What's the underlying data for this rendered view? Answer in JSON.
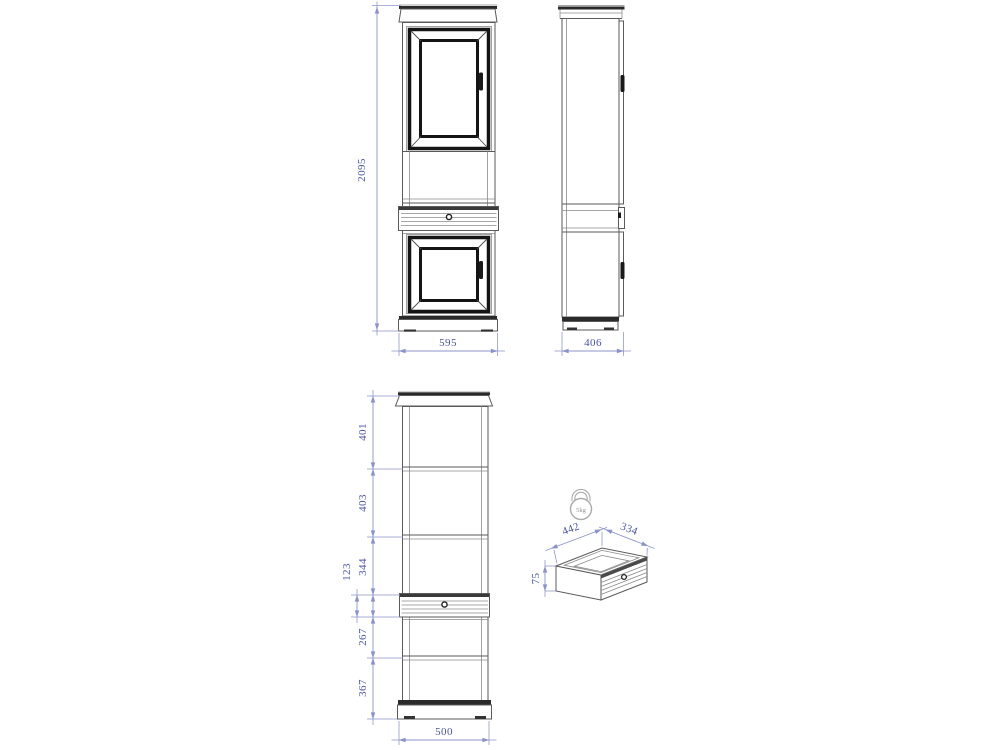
{
  "colors": {
    "background": "#ffffff",
    "object_line": "#5a5a5a",
    "door_frame": "#141414",
    "dimension_line": "#8b93c7",
    "dimension_text": "#4a55a2",
    "weight_icon": "#aaaaaa"
  },
  "views": {
    "front": {
      "name": "front elevation",
      "height": "2095",
      "width": "595"
    },
    "side": {
      "name": "side elevation",
      "width": "406"
    },
    "section": {
      "name": "front section with internal heights",
      "segments": [
        "401",
        "403",
        "344",
        "123",
        "267",
        "367"
      ],
      "width": "500"
    },
    "drawer": {
      "name": "drawer detail isometric",
      "width": "442",
      "depth": "334",
      "height": "75",
      "max_load": "5kg"
    }
  }
}
